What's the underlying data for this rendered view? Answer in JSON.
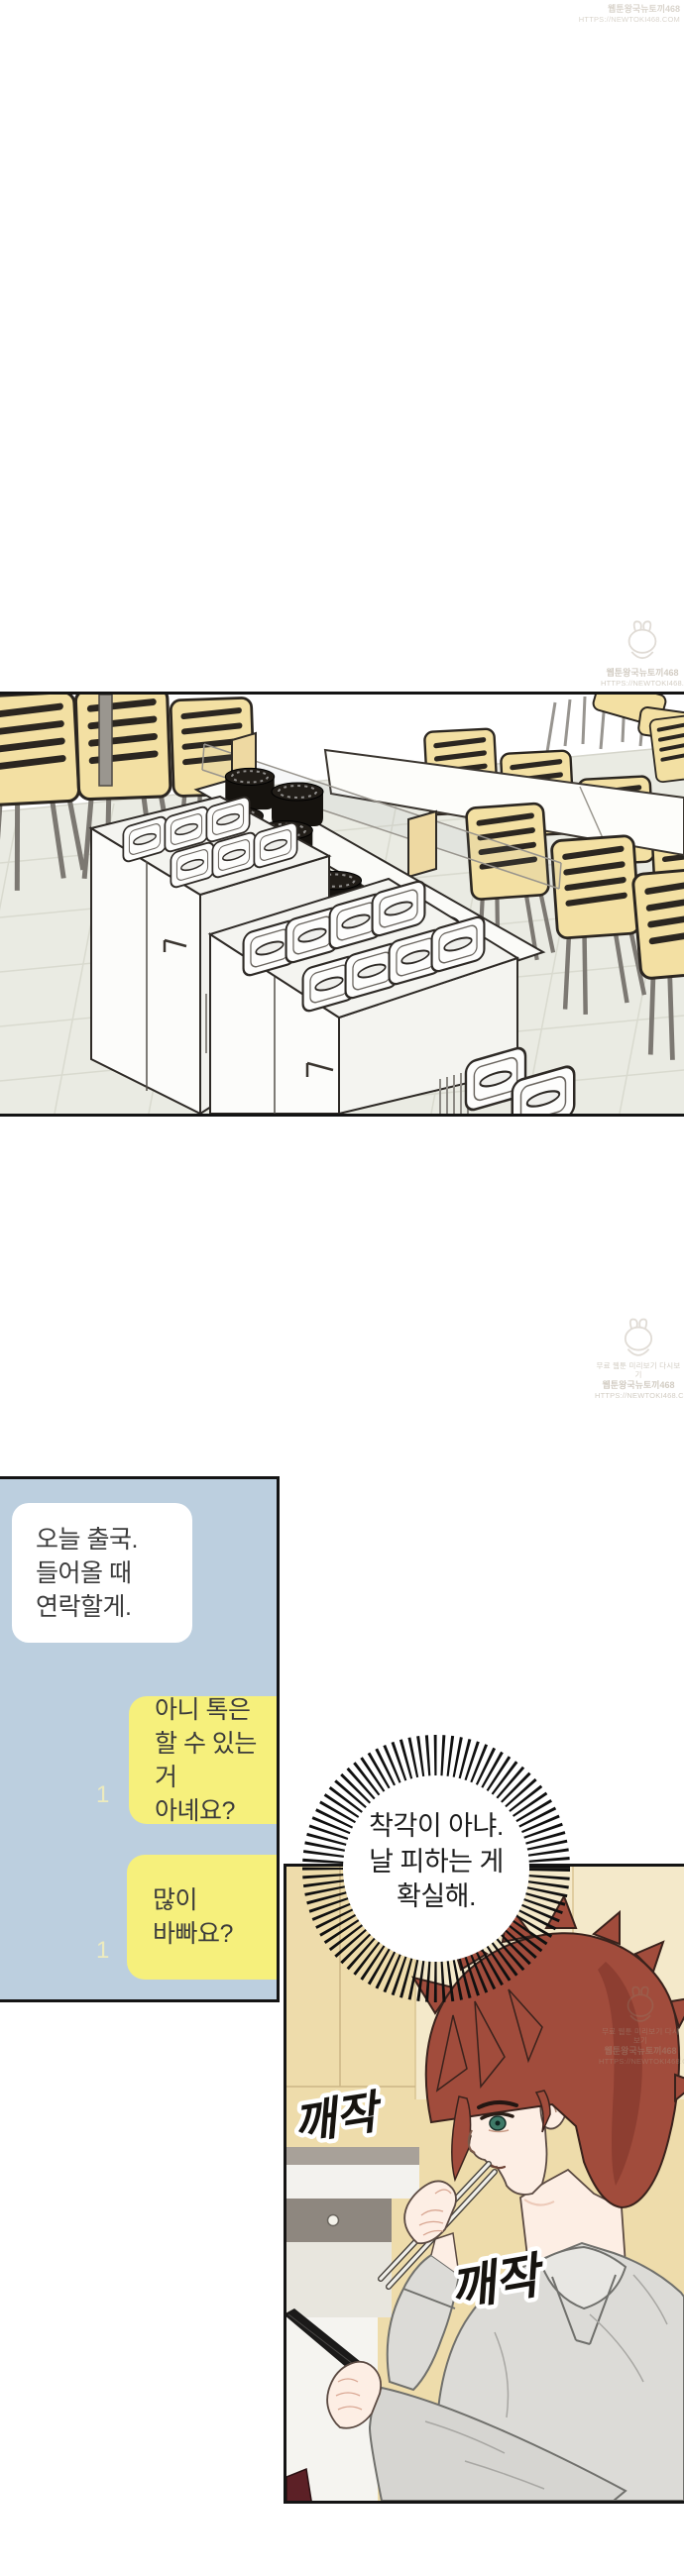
{
  "watermark": {
    "line_top": "무료 웹툰 미리보기 다시보기",
    "site_name": "웹툰왕국뉴토끼468",
    "site_url": "HTTPS://NEWTOKI468.COM"
  },
  "chat": {
    "received": {
      "text": "오늘 출국.\n들어올 때\n연락할게."
    },
    "sent_first": {
      "text": "아니 톡은\n할 수 있는 거\n아녜요?",
      "unread_count": "1"
    },
    "sent_second": {
      "text": "많이\n바빠요?",
      "unread_count": "1"
    }
  },
  "thought_bubble": {
    "text": "착각이 아냐.\n날 피하는 게\n확실해."
  },
  "sfx": {
    "first": "깨작",
    "second": "깨작"
  },
  "colors": {
    "chat_background": "#bccfdf",
    "sent_bubble_yellow": "#f6f07c",
    "received_bubble_white": "#ffffff",
    "unread_count_yellow": "#edebbe",
    "panel_border_black": "#141414",
    "chair_tan": "#f3e0a3",
    "hair_auburn": "#a14c3c",
    "kitchen_beige": "#eedcab",
    "shirt_gray": "#dcdbd7"
  }
}
